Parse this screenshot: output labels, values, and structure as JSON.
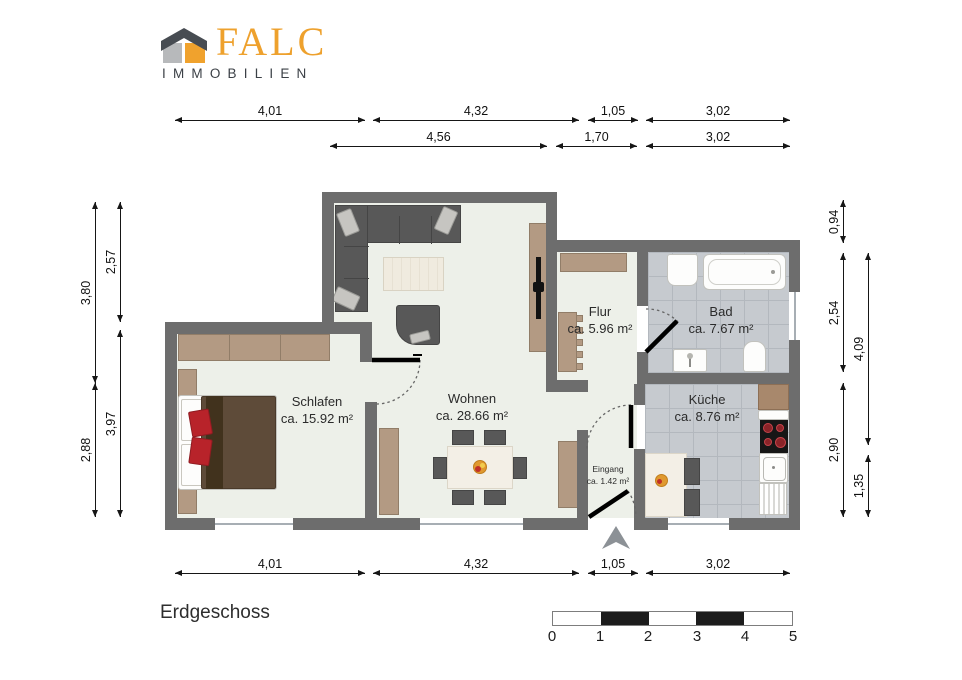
{
  "logo": {
    "brand": "FALC",
    "subtitle": "IMMOBILIEN",
    "colors": {
      "orange": "#EFA12D",
      "dark_gray": "#3B4046",
      "light_gray": "#B7B9BB"
    }
  },
  "floor_label": "Erdgeschoss",
  "rooms": [
    {
      "name": "Schlafen",
      "area": "ca. 15.92 m²"
    },
    {
      "name": "Wohnen",
      "area": "ca. 28.66 m²"
    },
    {
      "name": "Flur",
      "area": "ca. 5.96 m²"
    },
    {
      "name": "Bad",
      "area": "ca. 7.67 m²"
    },
    {
      "name": "Küche",
      "area": "ca. 8.76 m²"
    },
    {
      "name": "Eingang",
      "area": "ca. 1.42 m²"
    }
  ],
  "dimensions": {
    "top_row1": [
      "4,01",
      "4,32",
      "1,05",
      "3,02"
    ],
    "top_row2": [
      "4,56",
      "1,70",
      "3,02"
    ],
    "bottom": [
      "4,01",
      "4,32",
      "1,05",
      "3,02"
    ],
    "left_outer": [
      "3,80",
      "2,88"
    ],
    "left_inner": [
      "2,57",
      "3,97"
    ],
    "right_inner": [
      "0,94",
      "2,54",
      "2,90"
    ],
    "right_outer": [
      "4,09",
      "1,35"
    ]
  },
  "scale_bar": {
    "labels": [
      "0",
      "1",
      "2",
      "3",
      "4",
      "5"
    ]
  },
  "icons": {
    "north_arrow": "north-arrow",
    "house_logo": "falc-house-logo"
  }
}
